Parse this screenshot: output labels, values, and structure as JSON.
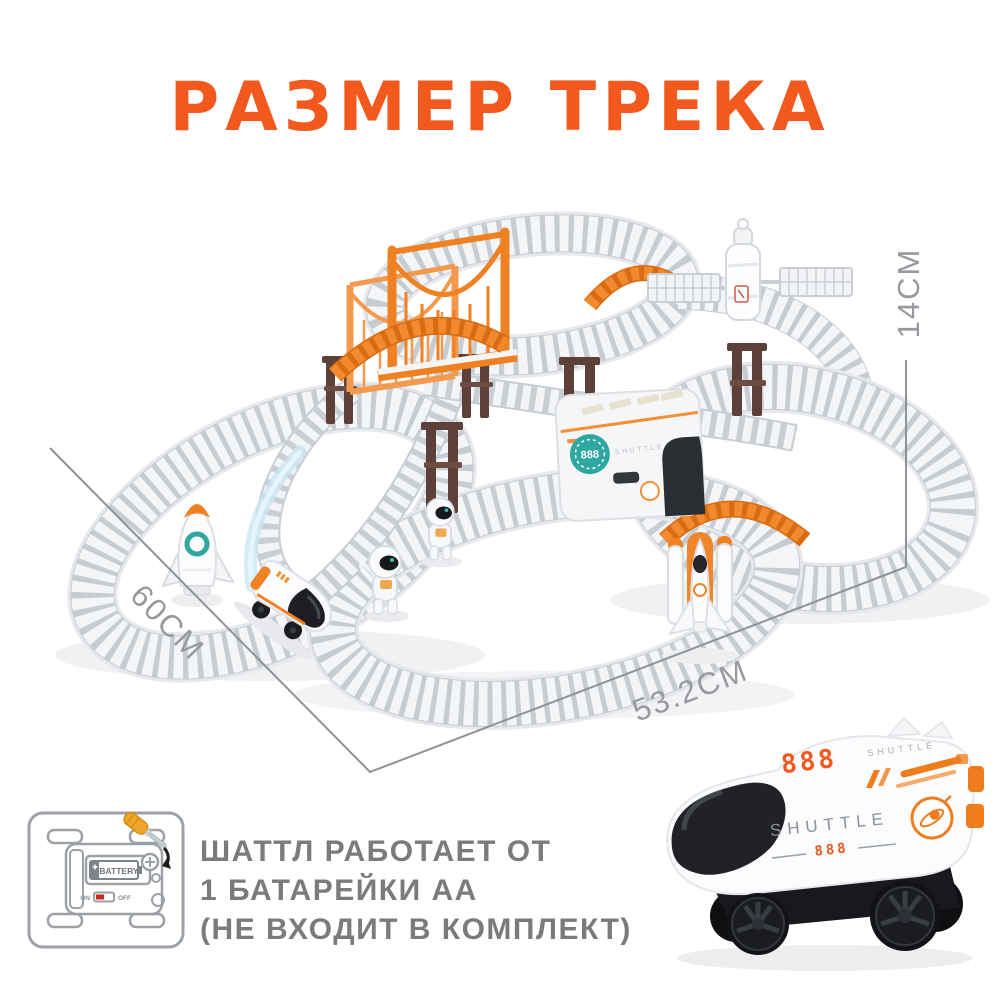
{
  "title": {
    "text": "РАЗМЕР ТРЕКА",
    "color": "#F3591C"
  },
  "dimensions": {
    "height": "14CM",
    "width": "60CM",
    "depth": "53.2CM",
    "line_color": "#8F9296",
    "label_color": "#97999E"
  },
  "scene": {
    "station_badge": "888",
    "station_label": "SHUTTLE",
    "icons": [
      "track-loops",
      "ladder-ramps",
      "suspension-bridge",
      "orange-curve-ramps",
      "bridge-pillars",
      "satellite",
      "rocket",
      "space-shuttle",
      "astronauts",
      "shuttle-train",
      "speed-swoosh"
    ]
  },
  "battery_note": {
    "lines": [
      "ШАТТЛ РАБОТАЕТ ОТ",
      "1 БАТАРЕЙКИ АА",
      "(НЕ ВХОДИТ В КОМПЛЕКТ)"
    ],
    "icon": {
      "battery_label": "BATTERY",
      "on_label": "ON",
      "off_label": "OFF"
    },
    "text_color": "#7B7B7B"
  },
  "shuttle_photo": {
    "top_number": "888",
    "top_label": "SHUTTLE",
    "side_label": "SHUTTLE",
    "side_number": "888",
    "accent_color": "#EF7D1E"
  }
}
